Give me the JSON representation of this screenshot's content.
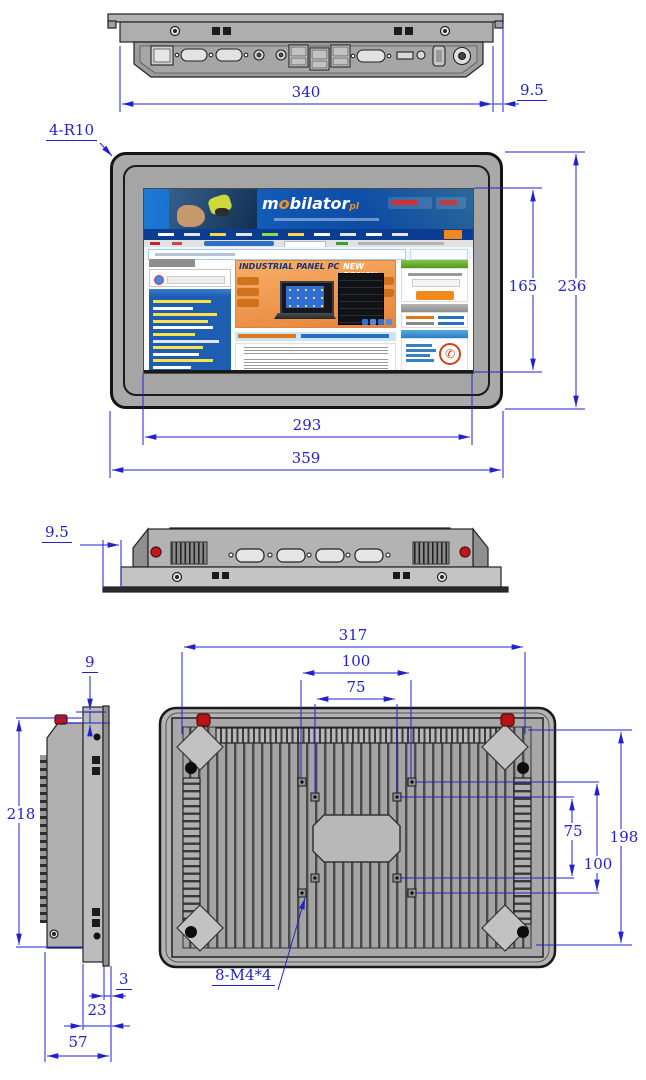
{
  "dimensions": {
    "top_width": "340",
    "top_flange": "9.5",
    "corner_radius": "4-R10",
    "display_height": "165",
    "front_height": "236",
    "display_width": "293",
    "front_width": "359",
    "side_flange": "9.5",
    "flange_overhang": "9",
    "body_height": "218",
    "cutout_width": "317",
    "vesa100_width": "100",
    "vesa75_width": "75",
    "vesa75_height": "75",
    "vesa100_height": "100",
    "cutout_height": "198",
    "front_lip": "3",
    "rear_depth": "23",
    "total_depth": "57",
    "mount_screws": "8-M4*4"
  },
  "screen": {
    "logo_m": "m",
    "logo_o": "o",
    "logo_rest": "bilator",
    "logo_tld": "pl",
    "banner_title": "INDUSTRIAL PANEL PC",
    "banner_subtitle": "NEW DESIGN"
  },
  "colors": {
    "dimension": "#2222cc",
    "accent_orange": "#f6921e",
    "power_red": "#c01818",
    "header_blue": "#0f55b0"
  }
}
